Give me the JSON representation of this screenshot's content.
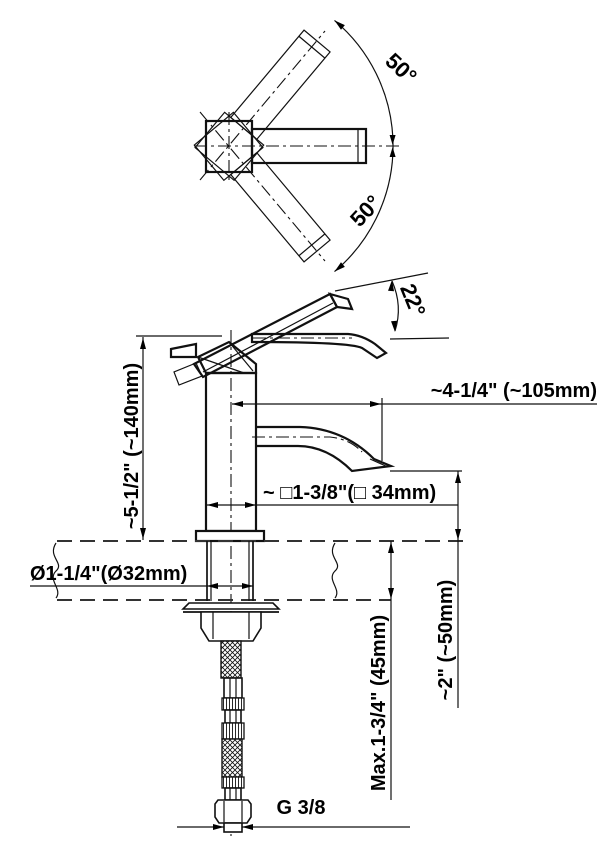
{
  "drawing": {
    "top_view": {
      "angle_up": "50°",
      "angle_down": "50°"
    },
    "side_view": {
      "lever_angle": "22°",
      "spout_reach": "~4-1/4\" (~105mm)",
      "body_height": "~5-1/2\" (~140mm)",
      "body_square": "~ □1-3/8\"(□ 34mm)",
      "hole_diameter": "Ø1-1/4\"(Ø32mm)",
      "spout_clearance": "~2\" (~50mm)",
      "max_deck_thickness": "Max.1-3/4\" (45mm)",
      "thread": "G 3/8"
    },
    "colors": {
      "line": "#111111",
      "background": "#ffffff"
    }
  }
}
